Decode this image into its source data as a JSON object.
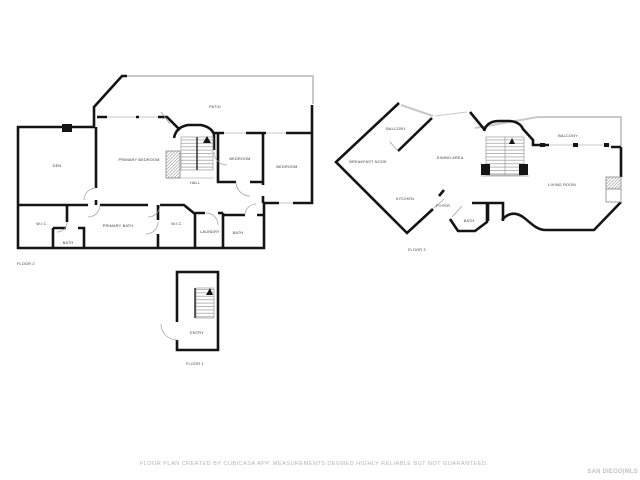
{
  "footer": {
    "disclaimer": "FLOOR PLAN CREATED BY CUBICASA APP. MEASUREMENTS DEEMED HIGHLY RELIABLE BUT NOT GUARANTEED.",
    "watermark": "SAN DIEGO|MLS"
  },
  "floor2": {
    "label": "FLOOR 2",
    "rooms": {
      "den": "DEN",
      "primary_bedroom": "PRIMARY BEDROOM",
      "patio": "PATIO",
      "hall": "HALL",
      "bedroom_mid": "BEDROOM",
      "bedroom_right": "BEDROOM",
      "wic_left": "W.I.C.",
      "bath_left": "BATH",
      "primary_bath": "PRIMARY BATH",
      "wic_right": "W.I.C.",
      "laundry": "LAUNDRY",
      "bath_right": "BATH"
    }
  },
  "floor3": {
    "label": "FLOOR 3",
    "rooms": {
      "balcony_left": "BALCONY",
      "breakfast_nook": "BREAKFAST NOOK",
      "dining_area": "DINING AREA",
      "kitchen": "KITCHEN",
      "foyer": "FOYER",
      "bath": "BATH",
      "living_room": "LIVING ROOM",
      "balcony_right": "BALCONY"
    }
  },
  "floor1": {
    "label": "FLOOR 1",
    "rooms": {
      "entry": "ENTRY"
    }
  },
  "colors": {
    "wall": "#141414",
    "outdoor": "#c9c9c9",
    "stairs": "#9a9a9a",
    "room_label": "#3d3d3d",
    "footer_text": "#b5b5b5",
    "watermark": "#c3c3c3"
  }
}
